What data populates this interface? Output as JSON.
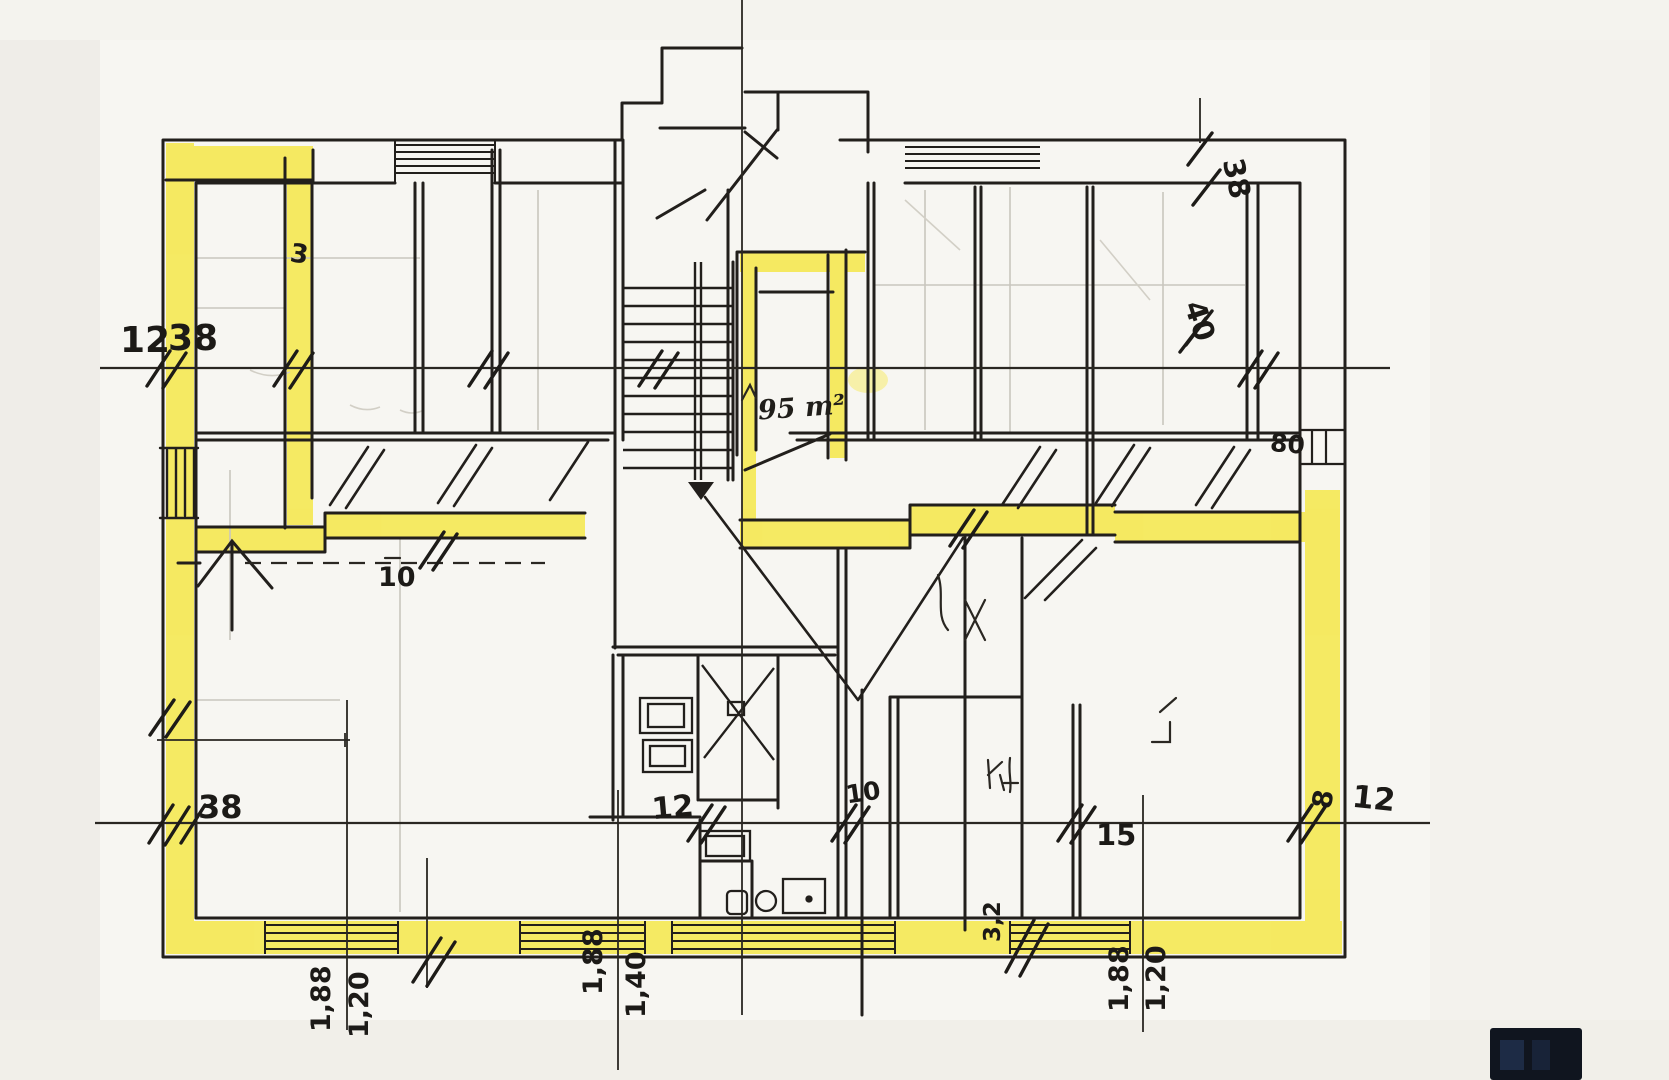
{
  "document": {
    "kind": "hand-drawn floor plan sketch",
    "highlight_color": "#f5e84e",
    "ink_color": "#221f1c",
    "paper_color": "#f7f6f2"
  },
  "labels": {
    "upper_left_12": "12",
    "upper_left_38": "38",
    "wall_mark_3": "3",
    "stair_area": "95 m²",
    "corridor_10": "10",
    "bottom_left_38": "38",
    "bottom_12": "12",
    "bottom_10": "10",
    "bottom_15": "15",
    "bottom_right_8": "8",
    "bottom_right_12": "12",
    "top_right_38": "38",
    "right_40": "40",
    "right_80": "80",
    "meas_left_a": "1,88",
    "meas_left_b": "1,20",
    "meas_center_a": "1,88",
    "meas_center_b": "1,40",
    "meas_wall_32": "3,2",
    "meas_right_a": "1,88",
    "meas_right_b": "1,20"
  }
}
